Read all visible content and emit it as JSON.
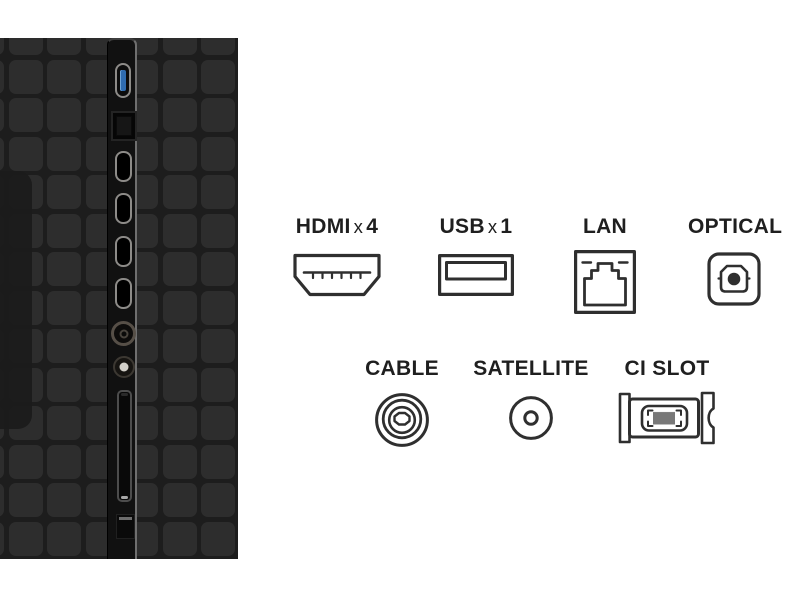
{
  "legend": {
    "hdmi": {
      "name": "HDMI",
      "multiplier_symbol": "x",
      "count": "4"
    },
    "usb": {
      "name": "USB",
      "multiplier_symbol": "x",
      "count": "1"
    },
    "lan": {
      "label": "LAN"
    },
    "optical": {
      "label": "OPTICAL"
    },
    "cable": {
      "label": "CABLE"
    },
    "satellite": {
      "label": "SATELLITE"
    },
    "ci_slot": {
      "label": "CI SLOT"
    }
  },
  "panel": {
    "ports_top_to_bottom": [
      "usb-port",
      "lan-port",
      "hdmi-port-1",
      "hdmi-port-2",
      "hdmi-port-3",
      "hdmi-port-4",
      "cable-port",
      "satellite-port",
      "ci-slot-port",
      "optical-port"
    ]
  },
  "colors": {
    "page_background": "#ffffff",
    "panel_background": "#1d1d1d",
    "panel_tile": "#2d2d2d",
    "panel_recess": "#1b1b1b",
    "port_strip": "#111111",
    "strip_highlight": "#6f6f6f",
    "usb_blue": "#2f6cb0",
    "port_outline": "#8d8b88",
    "icon_stroke": "#2f2f2f",
    "label_text": "#1f1f1f"
  }
}
